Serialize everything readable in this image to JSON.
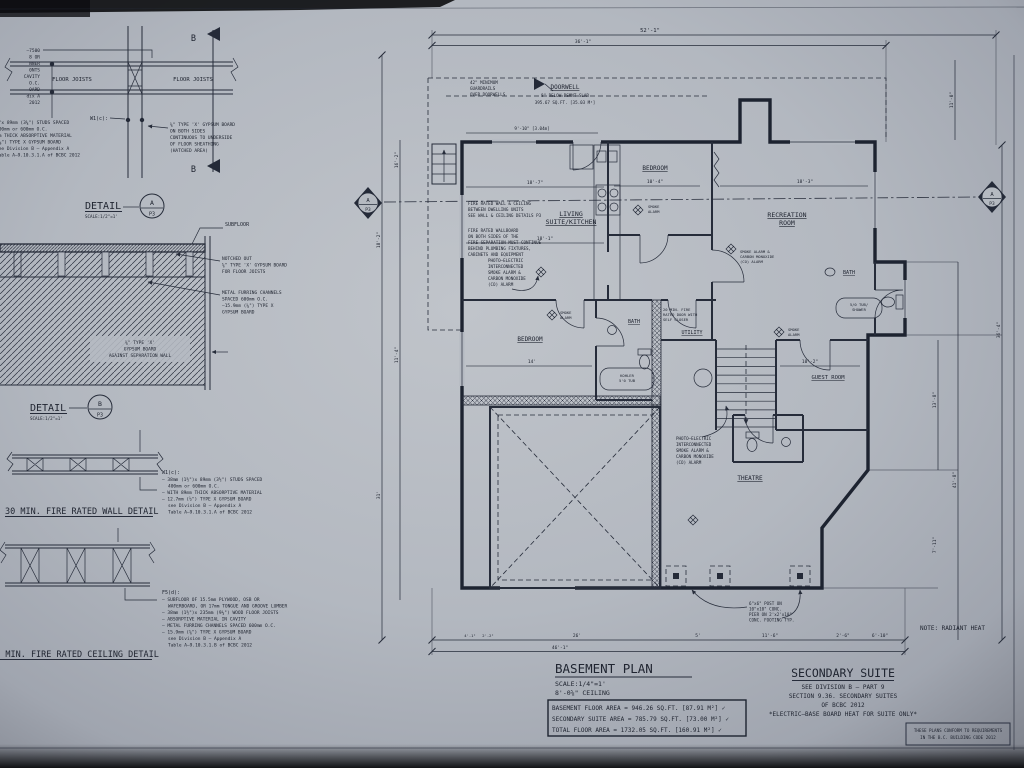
{
  "sheet": {
    "note_fragments": [
      "—7500",
      "8 OR",
      "NNER",
      "0NTS",
      "CAVITY",
      "O.C.",
      "OARD",
      "dix A",
      "2012"
    ]
  },
  "detail_a": {
    "title": "DETAIL",
    "scale": "SCALE:1/2\"=1'",
    "bubble_letter": "A",
    "bubble_sheet": "P3",
    "marker_top": "B",
    "marker_bottom": "B",
    "joists_left": "FLOOR JOISTS",
    "joists_right": "FLOOR JOISTS",
    "w1_tag": "W1(c):",
    "left_note": [
      "⅝\"x 89mm (3⅝\") STUDS SPACED",
      "400mm or 600mm O.C.",
      "mm THICK ABSORPTIVE MATERIAL",
      "(⅝\") TYPE X GYPSUM BOARD",
      "see Division B – Appendix A",
      "Table A–9.10.3.1.A of BCBC 2012"
    ],
    "right_note": [
      "⅝\" TYPE 'X' GYPSUM BOARD",
      "ON BOTH SIDES",
      "CONTINUOUS TO UNDERSIDE",
      "OF FLOOR SHEATHING",
      "(HATCHED AREA)"
    ]
  },
  "detail_b": {
    "title": "DETAIL",
    "scale": "SCALE:1/2\"=1'",
    "bubble_letter": "B",
    "bubble_sheet": "P3",
    "subfloor": "SUBFLOOR",
    "note_notched": [
      "NOTCHED OUT",
      "⅝\" TYPE 'X' GYPSUM BOARD",
      "FOR FLOOR JOISTS"
    ],
    "note_furring": [
      "METAL FURRING CHANNELS",
      "SPACED 600mm O.C.",
      "–15.9mm (⅝\") TYPE X",
      "GYPSUM BOARD"
    ],
    "hatch_label": [
      "⅝\" TYPE 'X'",
      "GYPSUM BOARD",
      "AGAINST SEPARATION WALL"
    ]
  },
  "wall_detail": {
    "title": "30 MIN. FIRE RATED WALL DETAIL",
    "tag": "W1(c):",
    "notes": [
      "– 38mm (1½\")x 89mm (3½\") STUDS SPACED",
      "400mm or 600mm O.C.",
      "– WITH 89mm THICK ABSORPTIVE MATERIAL",
      "– 12.7mm (½\") TYPE X GYPSUM BOARD",
      "see Division B – Appendix A",
      "Table A–9.10.3.1.A of BCBC 2012"
    ]
  },
  "ceiling_detail": {
    "title": "30 MIN. FIRE RATED CEILING DETAIL",
    "tag": "F5(d):",
    "notes": [
      "– SUBFLOOR OF 15.5mm PLYWOOD, OSB OR",
      "WAFERBOARD, OR 17mm TONGUE AND GROOVE LUMBER",
      "– 38mm (1½\")x 235mm (9¼\") WOOD FLOOR JOISTS",
      "– ABSORPTIVE MATERIAL IN CAVITY",
      "– METAL FURRING CHANNELS SPACED 600mm O.C.",
      "– 15.9mm (⅝\") TYPE X GYPSUM BOARD",
      "see Division B – Appendix A",
      "Table A–9.10.3.1.B of BCBC 2012"
    ]
  },
  "plan": {
    "rooms": {
      "bedroom_upper": "BEDROOM",
      "living1": "LIVING",
      "living2": "SUITE/KITCHEN",
      "recreation1": "RECREATION",
      "recreation2": "ROOM",
      "bath_right": "BATH",
      "bedroom_lower": "BEDROOM",
      "bath_mid": "BATH",
      "utility": "UTILITY",
      "guest": "GUEST ROOM",
      "theatre": "THEATRE"
    },
    "doorwell": [
      "DOORWELL",
      "8\" BELOW BSMNT SLAB",
      "395.67 SQ.FT. [35.03 M²]"
    ],
    "guardrail": [
      "42\" MINIMUM",
      "GUARDRAILS",
      "OVER DOORWELLS"
    ],
    "fire_note1": [
      "FIRE RATED WALL & CEILING",
      "BETWEEN DWELLING UNITS",
      "SEE WALL & CEILING DETAILS P3"
    ],
    "fire_note2": [
      "FIRE RATED WALLBOARD",
      "ON BOTH SIDES OF THE",
      "FIRE SEPARATION MUST CONTINUE",
      "BEHIND PLUMBING FIXTURES,",
      "CABINETS AND EQUIPMENT"
    ],
    "smoke_note_a": [
      "PHOTO–ELECTRIC",
      "INTERCONNECTED",
      "SMOKE ALARM &",
      "CARBON MONOXIDE",
      "(CO) ALARM"
    ],
    "smoke_note_b": [
      "PHOTO–ELECTRIC",
      "INTERCONNECTED",
      "SMOKE ALARM &",
      "CARBON MONOXIDE",
      "(CO) ALARM"
    ],
    "smoke_co": [
      "SMOKE ALARM &",
      "CARBON MONOXIDE",
      "(CO) ALARM"
    ],
    "smoke1": [
      "SMOKE",
      "ALARM"
    ],
    "smoke2": [
      "SMOKE",
      "ALARM"
    ],
    "smoke3": [
      "SMOKE",
      "ALARM"
    ],
    "door_note": [
      "20 MIN. FIRE",
      "RATED DOOR WITH",
      "SELF CLOSER"
    ],
    "tub_right": [
      "5/0 TUB/",
      "SHOWER"
    ],
    "tub_mid": [
      "KOHLER",
      "5'0 TUB"
    ],
    "post_note": [
      "6\"x6\" POST ON",
      "10\"x10\" CONC.",
      "PIER ON 2'x2'x10\"",
      "CONC. FOOTING TYP."
    ],
    "radiant": "NOTE: RADIANT HEAT",
    "marker_letter": "A",
    "marker_sheet": "P3",
    "dims": {
      "d1": "52'-1\"",
      "d2": "36'-1\"",
      "d3": "9'-10\" [3.04m]",
      "d4": "18'-7\"",
      "d5": "10'-4\"",
      "d6": "18'-3\"",
      "d7": "18'-1\"",
      "d8": "14'",
      "d9": "11'-0\"",
      "d10": "36'-4\"",
      "d11": "13'-8\"",
      "d12": "7'-11\"",
      "d13": "41'-8\"",
      "d14": "18'-2\"",
      "d15": "16'-2\"",
      "d16": "11'-4\"",
      "d17": "31'",
      "d18": "26'",
      "d19": "46'-1\"",
      "d20": "5'",
      "d21": "11'-6\"",
      "d22": "2'-6\"",
      "d23": "6'-10\"",
      "d24": "10'-2\"",
      "d25": "4'-1\"",
      "d26": "2'-2\""
    }
  },
  "titleblock": {
    "title": "BASEMENT PLAN",
    "scale": "SCALE:1/4\"=1'",
    "ceiling": "8'-0⅝\" CEILING",
    "areas": [
      "BASEMENT FLOOR AREA = 946.26 SQ.FT. [87.91 M²] ✓",
      "SECONDARY SUITE AREA = 785.79 SQ.FT. [73.00 M²] ✓",
      "TOTAL FLOOR AREA = 1732.05 SQ.FT. [160.91 M²] ✓"
    ]
  },
  "secondary": {
    "title": "SECONDARY SUITE",
    "lines": [
      "SEE DIVISION B — PART 9",
      "SECTION 9.36. SECONDARY SUITES",
      "OF BCBC 2012",
      "*ELECTRIC–BASE BOARD HEAT FOR SUITE ONLY*"
    ]
  },
  "stamp": [
    "THESE PLANS CONFORM TO REQUIREMENTS",
    "IN THE B.C. BUILDING CODE 2012"
  ]
}
